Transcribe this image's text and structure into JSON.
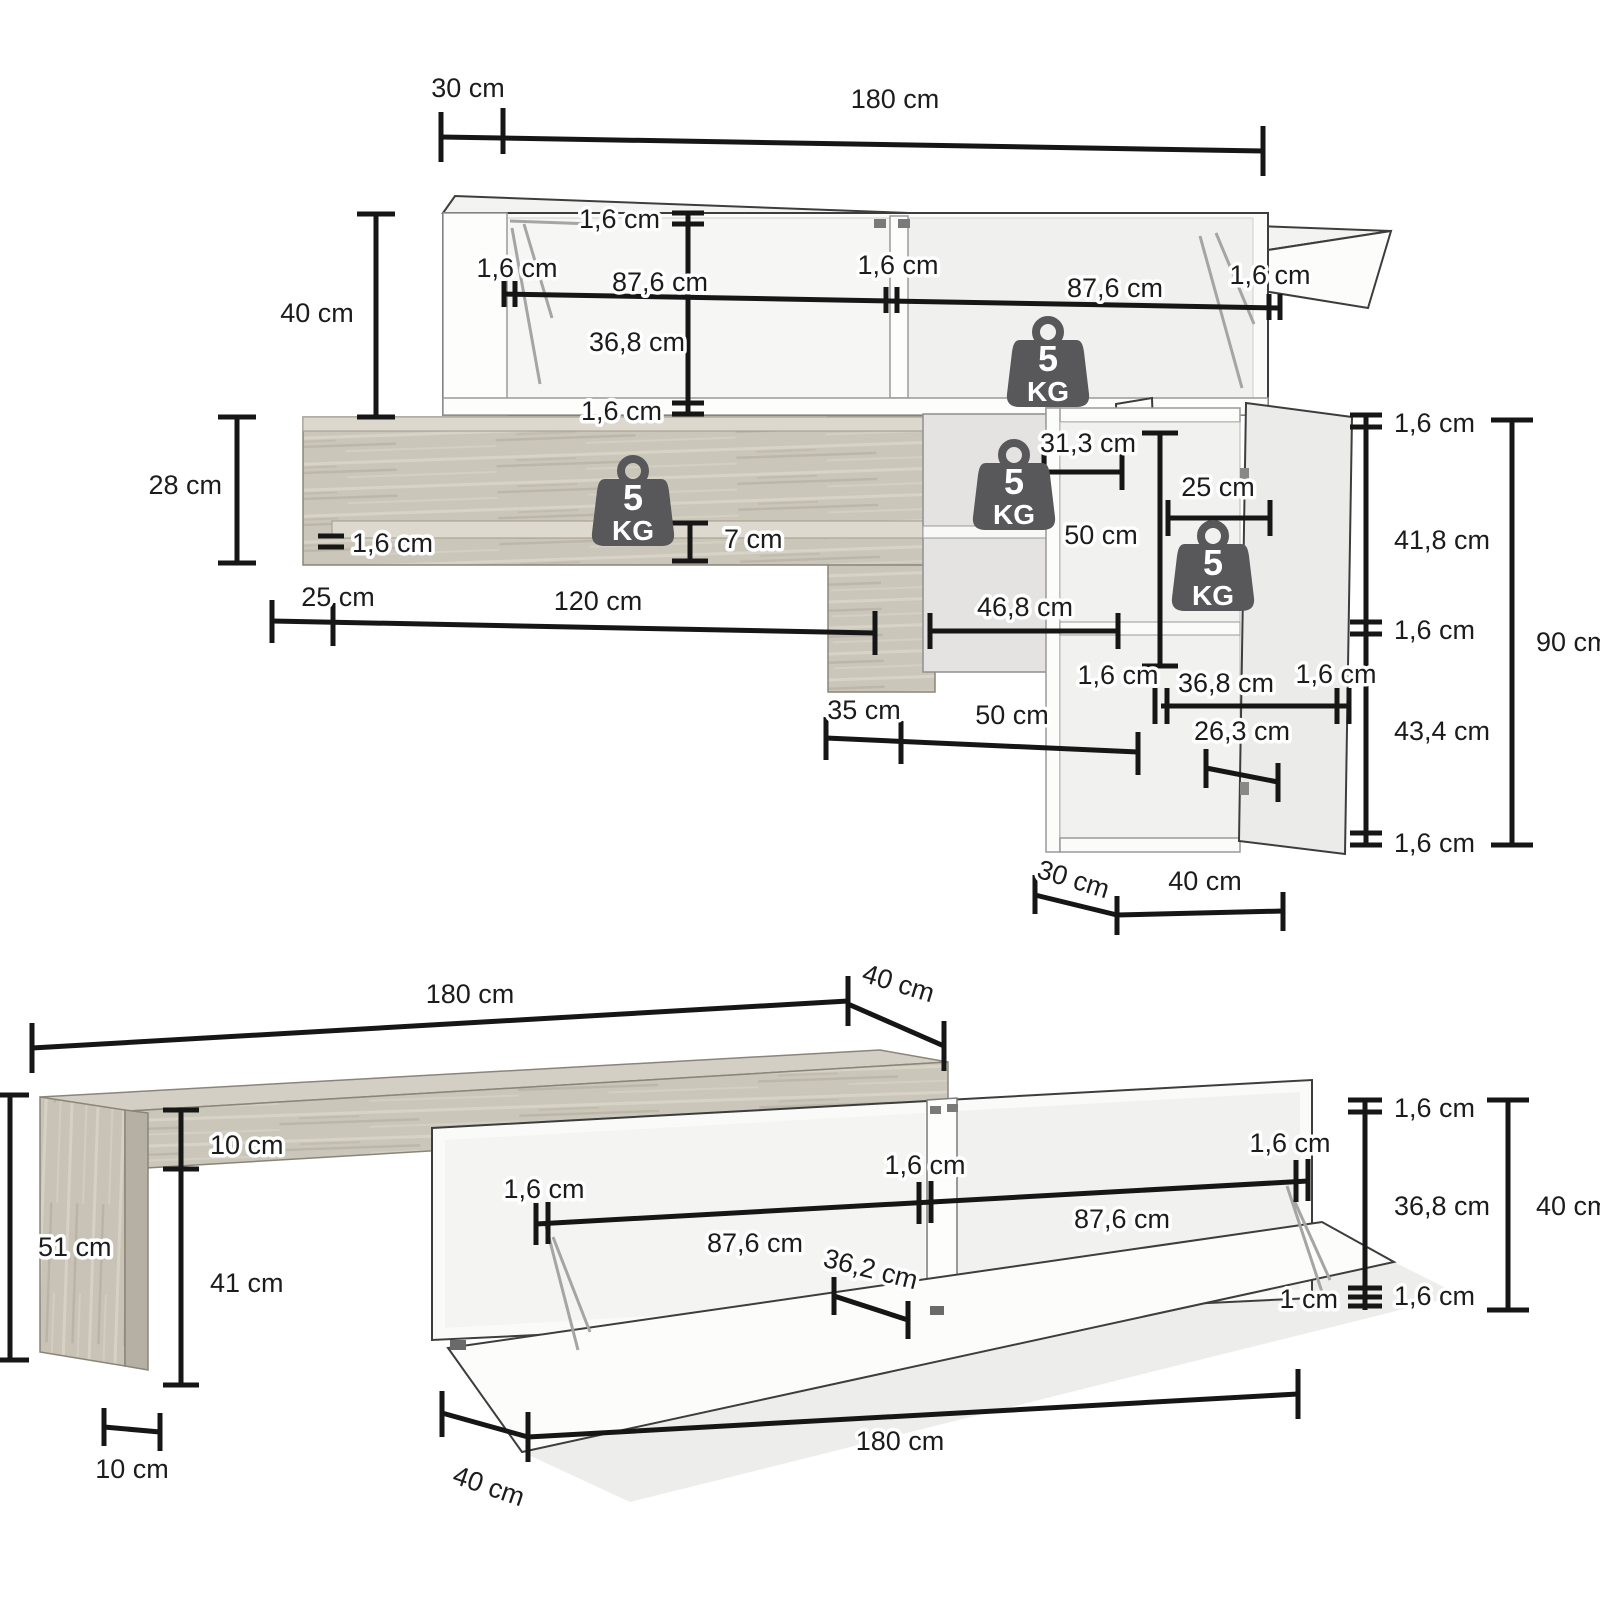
{
  "colors": {
    "ink": "#161616",
    "furniture_line": "#3d3d3d",
    "wood": "#cbc6ba",
    "wood_light": "#dcd8cd",
    "badge_fill": "#58585a",
    "badge_text": "#ffffff",
    "interior_shade": "#e4e3e1"
  },
  "weight_badge": {
    "value": "5",
    "unit": "KG"
  },
  "top_diagram": {
    "depth_top": "30 cm",
    "width_top": "180 cm",
    "upper_height": "40 cm",
    "upper_top": "1,6 cm",
    "upper_left": "1,6 cm",
    "upper_inner_left": "87,6 cm",
    "upper_divider": "1,6 cm",
    "upper_inner_right": "87,6 cm",
    "upper_right": "1,6 cm",
    "upper_inner_height": "36,8 cm",
    "upper_bottom": "1,6 cm",
    "shelf_height": "28 cm",
    "shelf_thickness": "1,6 cm",
    "shelf_gap": "7 cm",
    "shelf_offset": "25 cm",
    "shelf_width": "120 cm",
    "mid_inner_top": "31,3 cm",
    "mid_height": "50 cm",
    "mid_inner_bottom": "46,8 cm",
    "right_shelf_depth": "25 cm",
    "right_top": "1,6 cm",
    "right_inner_top": "41,8 cm",
    "right_shelf": "1,6 cm",
    "right_inner_bottom": "43,4 cm",
    "right_bottom": "1,6 cm",
    "right_height": "90 cm",
    "rb_left": "1,6 cm",
    "rb_inner": "36,8 cm",
    "rb_right": "1,6 cm",
    "rb_offset": "35 cm",
    "rb_span": "50 cm",
    "door_inner": "26,3 cm",
    "base_depth": "30 cm",
    "base_width": "40 cm"
  },
  "bottom_diagram": {
    "width_top": "180 cm",
    "depth_top": "40 cm",
    "total_height": "51 cm",
    "top_thickness": "10 cm",
    "leg_inner": "41 cm",
    "leg_width": "10 cm",
    "cab_left": "1,6 cm",
    "cab_inner_left": "87,6 cm",
    "cab_divider": "1,6 cm",
    "cab_inner_right": "87,6 cm",
    "cab_flap": "1,6 cm",
    "cab_shelf_depth": "36,2 cm",
    "cab_gap": "1 cm",
    "cab_top": "1,6 cm",
    "cab_inner_height": "36,8 cm",
    "cab_bottom": "1,6 cm",
    "cab_height": "40 cm",
    "width_bottom": "180 cm",
    "depth_bottom": "40 cm"
  }
}
